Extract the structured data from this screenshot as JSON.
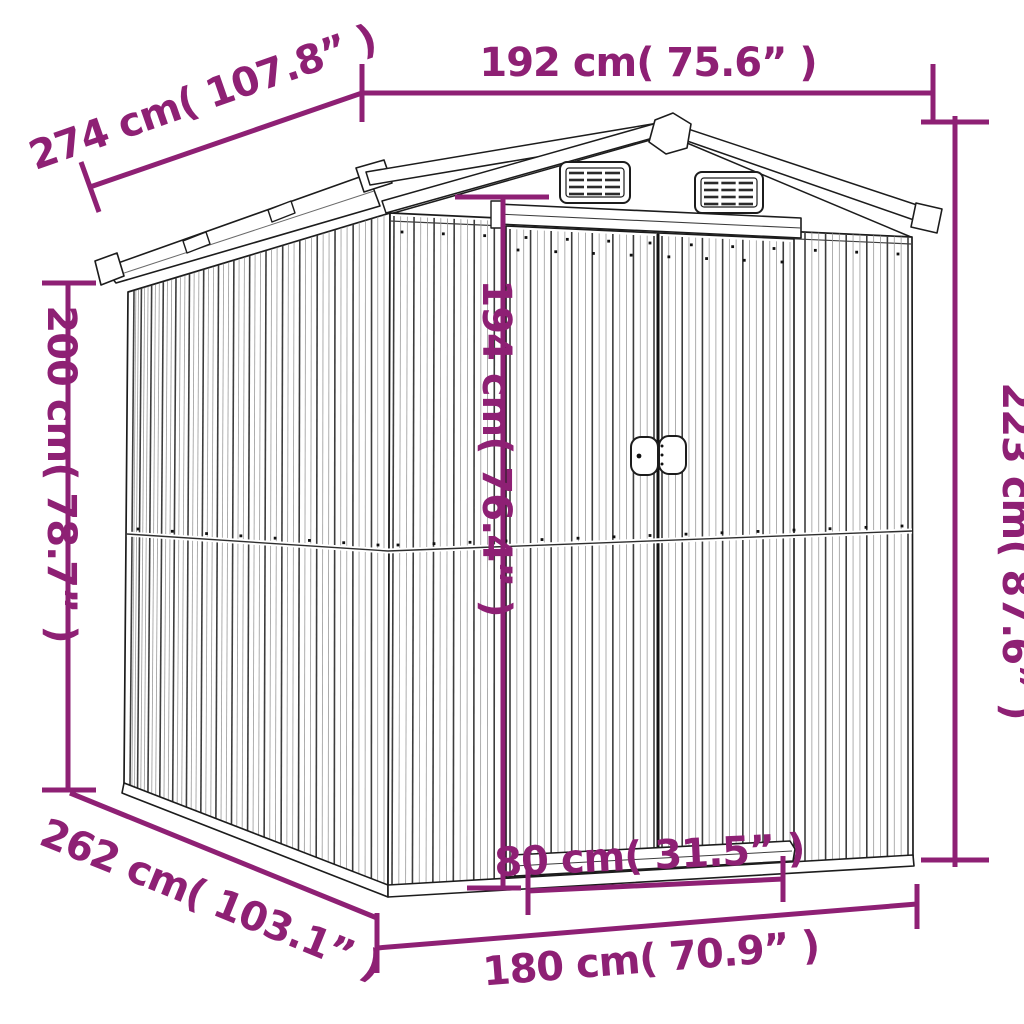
{
  "diagram": {
    "type": "product-dimension-diagram",
    "subject": "garden-shed-line-drawing"
  },
  "colors": {
    "dimension_accent": "#8E2074",
    "drawing_outline": "#1c1c1c",
    "background": "#ffffff"
  },
  "dimensions": {
    "roof_width": {
      "label": "192 cm( 75.6” )",
      "cm": "192",
      "inches": "75.6"
    },
    "roof_depth": {
      "label": "274 cm( 107.8” )",
      "cm": "274",
      "inches": "107.8"
    },
    "wall_height": {
      "label": "200 cm( 78.7” )",
      "cm": "200",
      "inches": "78.7"
    },
    "total_height": {
      "label": "223 cm( 87.6” )",
      "cm": "223",
      "inches": "87.6"
    },
    "door_height": {
      "label": "194 cm( 76.4” )",
      "cm": "194",
      "inches": "76.4"
    },
    "door_width": {
      "label": "80 cm( 31.5” )",
      "cm": "80",
      "inches": "31.5"
    },
    "base_width": {
      "label": "180 cm( 70.9” )",
      "cm": "180",
      "inches": "70.9"
    },
    "base_depth": {
      "label": "262 cm( 103.1” )",
      "cm": "262",
      "inches": "103.1"
    }
  }
}
